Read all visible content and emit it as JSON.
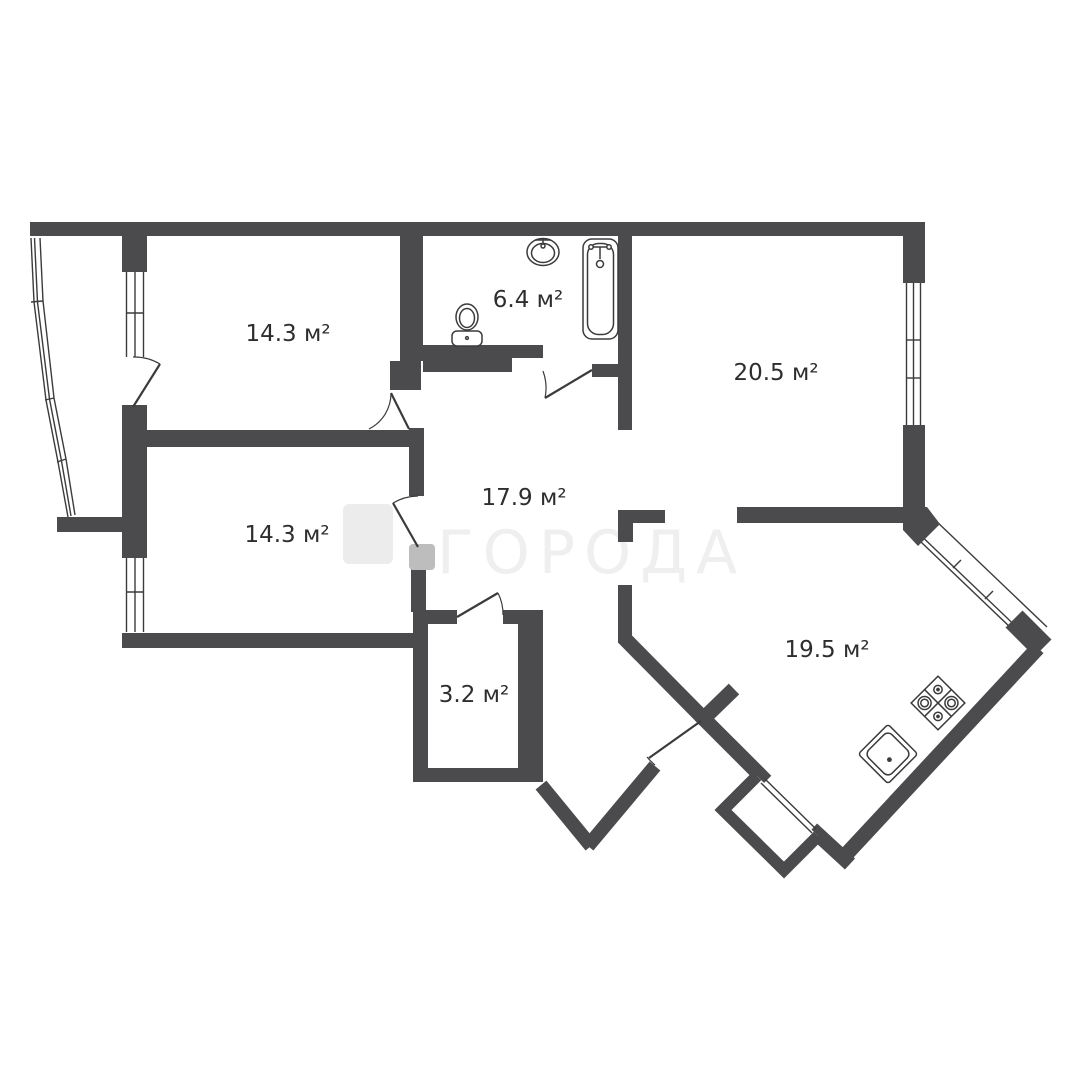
{
  "floor_plan": {
    "watermark": {
      "text": "ГОРОДА"
    },
    "rooms": [
      {
        "id": "bedroom-top-left",
        "area_label": "14.3 м²"
      },
      {
        "id": "bedroom-bottom-left",
        "area_label": "14.3 м²"
      },
      {
        "id": "bathroom",
        "area_label": "6.4 м²"
      },
      {
        "id": "hallway",
        "area_label": "17.9 м²"
      },
      {
        "id": "room-top-right",
        "area_label": "20.5 м²"
      },
      {
        "id": "storage",
        "area_label": "3.2 м²"
      },
      {
        "id": "kitchen-living",
        "area_label": "19.5 м²"
      }
    ],
    "fixtures": [
      "bathtub",
      "bathroom-sink",
      "toilet",
      "stove",
      "kitchen-sink"
    ],
    "colors": {
      "wall": "#4b4b4d",
      "line": "#3b3b3b",
      "label": "#2e2e2e",
      "watermark": "#efefef",
      "logo_light": "#ececec",
      "logo_medium": "#bdbdbd",
      "background": "#ffffff"
    }
  }
}
